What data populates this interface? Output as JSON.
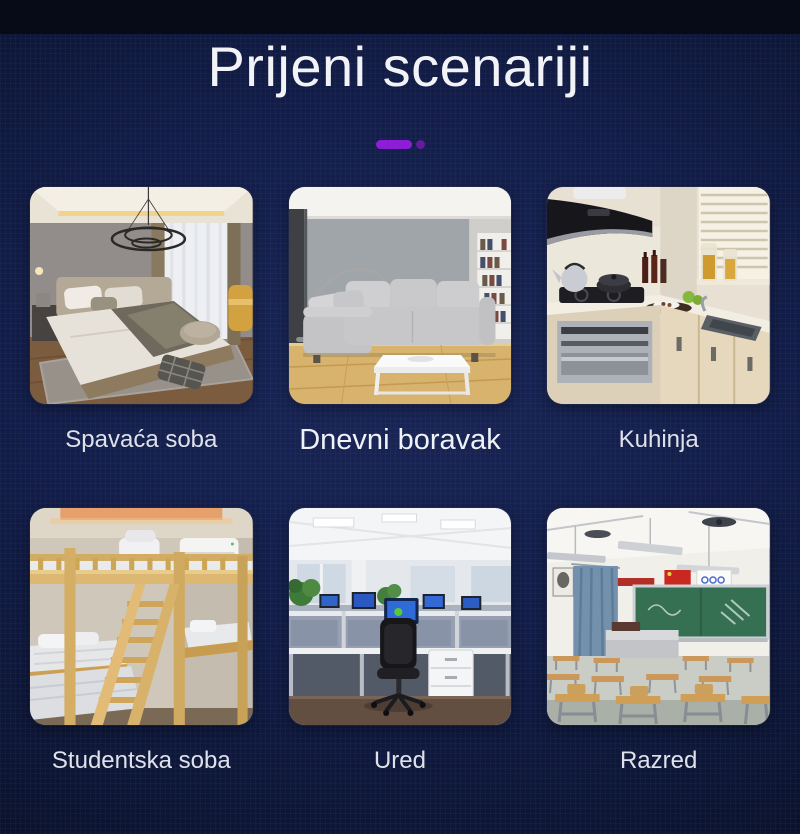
{
  "title": "Prijeni scenariji",
  "accent": {
    "bar_color": "#8e1ed6",
    "dot_color": "#6a1ca6"
  },
  "theme": {
    "background_center": "#182453",
    "background_edge": "#070b18",
    "grid_line_color": "#3a52a0",
    "title_color": "#f2f3f6",
    "label_color": "#dfe2ea",
    "label_emphasis_color": "#f0f2f7"
  },
  "cards": [
    {
      "label": "Spavaća soba",
      "scene": "bedroom",
      "emphasized": false
    },
    {
      "label": "Dnevni boravak",
      "scene": "living-room",
      "emphasized": true
    },
    {
      "label": "Kuhinja",
      "scene": "kitchen",
      "emphasized": false
    },
    {
      "label": "Studentska soba",
      "scene": "student-room",
      "emphasized": false
    },
    {
      "label": "Ured",
      "scene": "office",
      "emphasized": false
    },
    {
      "label": "Razred",
      "scene": "classroom",
      "emphasized": false
    }
  ]
}
